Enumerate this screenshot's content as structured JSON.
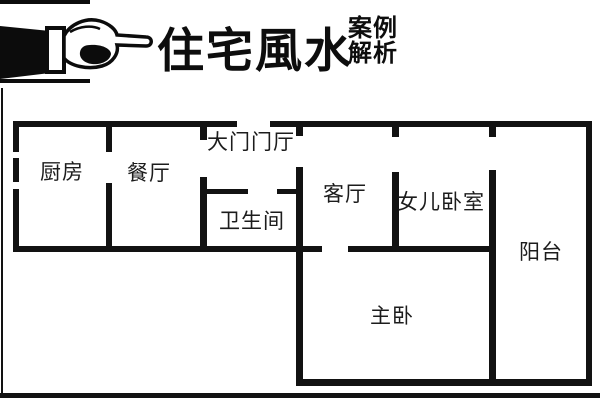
{
  "header": {
    "title": "住宅風水",
    "subtitle_line1": "案例",
    "subtitle_line2": "解析",
    "icon": "pointing-hand-right"
  },
  "floor_plan": {
    "rooms": {
      "kitchen": "厨房",
      "dining_room": "餐厅",
      "entry_hall": "大门门厅",
      "bathroom": "卫生间",
      "living_room": "客厅",
      "daughter_bedroom": "女儿卧室",
      "balcony": "阳台",
      "master_bedroom": "主卧"
    },
    "colors": {
      "wall": "#121212",
      "background": "#ffffff",
      "label_text": "#1c1c1c"
    }
  }
}
